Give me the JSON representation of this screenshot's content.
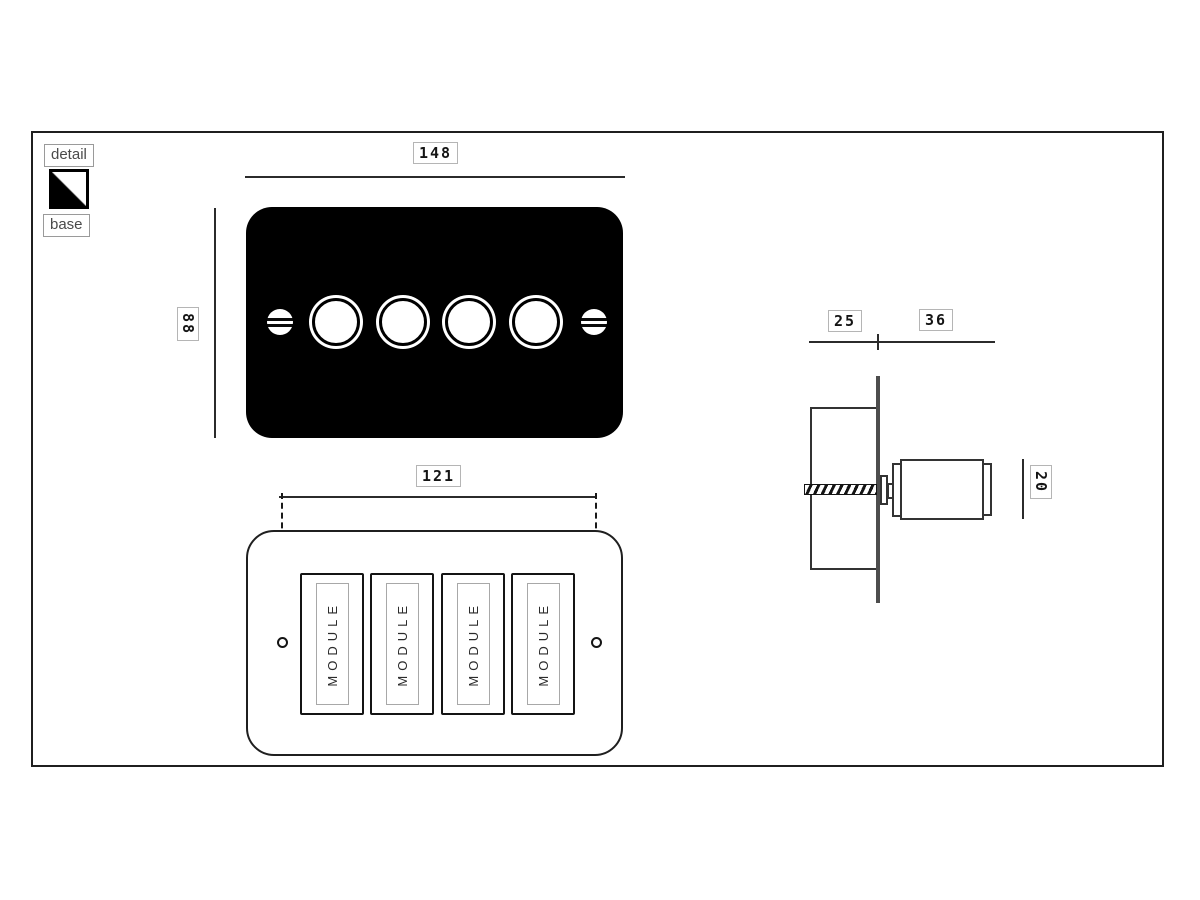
{
  "colors": {
    "plate_front": "#000000",
    "line": "#2b2b2b",
    "wall_plate": "#4d4d4d",
    "dim_box_border": "#b5b5b5",
    "dim_text": "#141414",
    "legend_text": "#4a4a4a",
    "module_text": "#2b2b2b"
  },
  "legend": {
    "detail_label": "detail",
    "base_label": "base",
    "swatch": {
      "detail_color": "#000000",
      "base_color": "#ffffff"
    }
  },
  "front_view": {
    "width_dim": "148",
    "height_dim": "88",
    "knob_count": 4,
    "screw_count": 2
  },
  "base_view": {
    "width_dim": "121",
    "modules": [
      {
        "label": "MODULE"
      },
      {
        "label": "MODULE"
      },
      {
        "label": "MODULE"
      },
      {
        "label": "MODULE"
      }
    ]
  },
  "side_view": {
    "behind_wall_dim": "25",
    "front_of_wall_dim": "36",
    "knob_diameter_dim": "20"
  }
}
